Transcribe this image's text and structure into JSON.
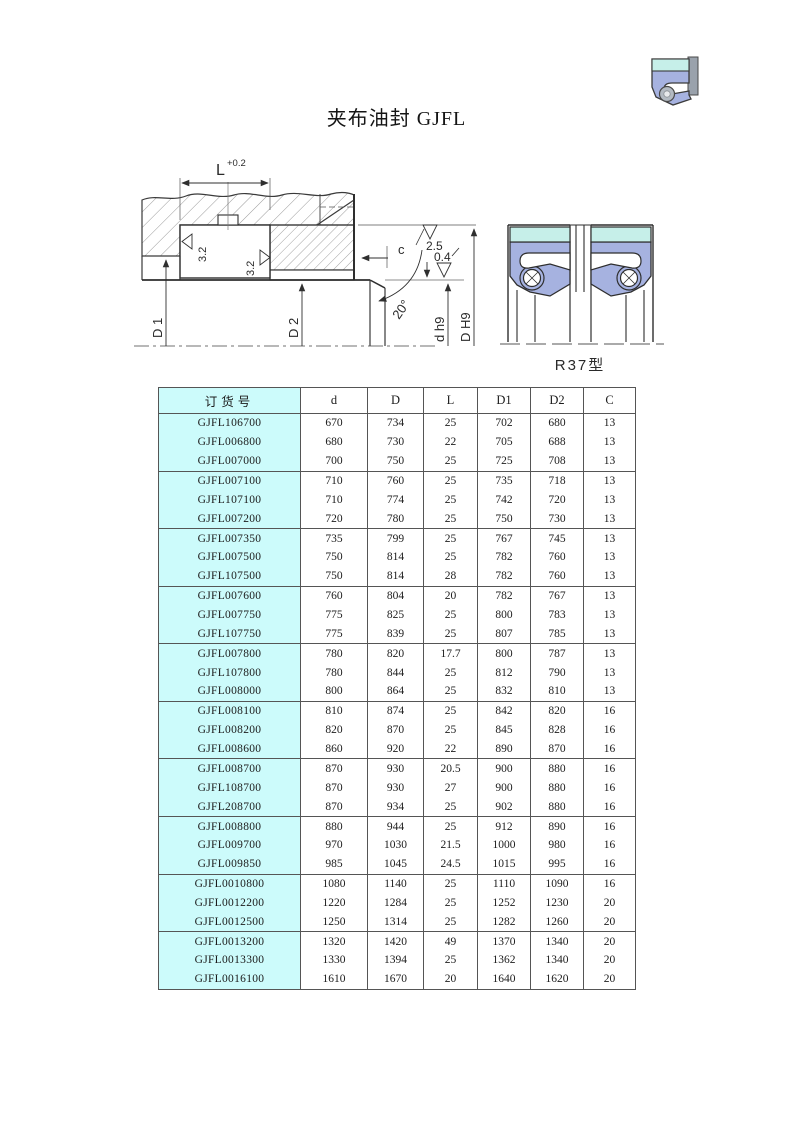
{
  "page": {
    "title": "夹布油封 GJFL"
  },
  "colors": {
    "table_highlight": "#ccfbfb",
    "table_border": "#555555",
    "seal_band": "#c6efe9",
    "seal_body": "#a6b2e0"
  },
  "diagram": {
    "installation": {
      "dim_L": "L",
      "dim_L_tolerance": "+0.2",
      "roughness_gland_left": "3.2",
      "roughness_gland_right": "3.2",
      "roughness_bore": "2.5",
      "roughness_shaft": "0.4",
      "dim_c": "c",
      "chamfer_angle": "20°",
      "dim_D1": "D 1",
      "dim_D2": "D 2",
      "dim_shaft": "d h9",
      "dim_bore": "D H9"
    },
    "profile": {
      "type_label": "R37型"
    }
  },
  "table": {
    "headers": [
      "订货号",
      "d",
      "D",
      "L",
      "D1",
      "D2",
      "C"
    ],
    "group_size": 3,
    "rows": [
      [
        "GJFL106700",
        "670",
        "734",
        "25",
        "702",
        "680",
        "13"
      ],
      [
        "GJFL006800",
        "680",
        "730",
        "22",
        "705",
        "688",
        "13"
      ],
      [
        "GJFL007000",
        "700",
        "750",
        "25",
        "725",
        "708",
        "13"
      ],
      [
        "GJFL007100",
        "710",
        "760",
        "25",
        "735",
        "718",
        "13"
      ],
      [
        "GJFL107100",
        "710",
        "774",
        "25",
        "742",
        "720",
        "13"
      ],
      [
        "GJFL007200",
        "720",
        "780",
        "25",
        "750",
        "730",
        "13"
      ],
      [
        "GJFL007350",
        "735",
        "799",
        "25",
        "767",
        "745",
        "13"
      ],
      [
        "GJFL007500",
        "750",
        "814",
        "25",
        "782",
        "760",
        "13"
      ],
      [
        "GJFL107500",
        "750",
        "814",
        "28",
        "782",
        "760",
        "13"
      ],
      [
        "GJFL007600",
        "760",
        "804",
        "20",
        "782",
        "767",
        "13"
      ],
      [
        "GJFL007750",
        "775",
        "825",
        "25",
        "800",
        "783",
        "13"
      ],
      [
        "GJFL107750",
        "775",
        "839",
        "25",
        "807",
        "785",
        "13"
      ],
      [
        "GJFL007800",
        "780",
        "820",
        "17.7",
        "800",
        "787",
        "13"
      ],
      [
        "GJFL107800",
        "780",
        "844",
        "25",
        "812",
        "790",
        "13"
      ],
      [
        "GJFL008000",
        "800",
        "864",
        "25",
        "832",
        "810",
        "13"
      ],
      [
        "GJFL008100",
        "810",
        "874",
        "25",
        "842",
        "820",
        "16"
      ],
      [
        "GJFL008200",
        "820",
        "870",
        "25",
        "845",
        "828",
        "16"
      ],
      [
        "GJFL008600",
        "860",
        "920",
        "22",
        "890",
        "870",
        "16"
      ],
      [
        "GJFL008700",
        "870",
        "930",
        "20.5",
        "900",
        "880",
        "16"
      ],
      [
        "GJFL108700",
        "870",
        "930",
        "27",
        "900",
        "880",
        "16"
      ],
      [
        "GJFL208700",
        "870",
        "934",
        "25",
        "902",
        "880",
        "16"
      ],
      [
        "GJFL008800",
        "880",
        "944",
        "25",
        "912",
        "890",
        "16"
      ],
      [
        "GJFL009700",
        "970",
        "1030",
        "21.5",
        "1000",
        "980",
        "16"
      ],
      [
        "GJFL009850",
        "985",
        "1045",
        "24.5",
        "1015",
        "995",
        "16"
      ],
      [
        "GJFL0010800",
        "1080",
        "1140",
        "25",
        "1110",
        "1090",
        "16"
      ],
      [
        "GJFL0012200",
        "1220",
        "1284",
        "25",
        "1252",
        "1230",
        "20"
      ],
      [
        "GJFL0012500",
        "1250",
        "1314",
        "25",
        "1282",
        "1260",
        "20"
      ],
      [
        "GJFL0013200",
        "1320",
        "1420",
        "49",
        "1370",
        "1340",
        "20"
      ],
      [
        "GJFL0013300",
        "1330",
        "1394",
        "25",
        "1362",
        "1340",
        "20"
      ],
      [
        "GJFL0016100",
        "1610",
        "1670",
        "20",
        "1640",
        "1620",
        "20"
      ]
    ]
  }
}
